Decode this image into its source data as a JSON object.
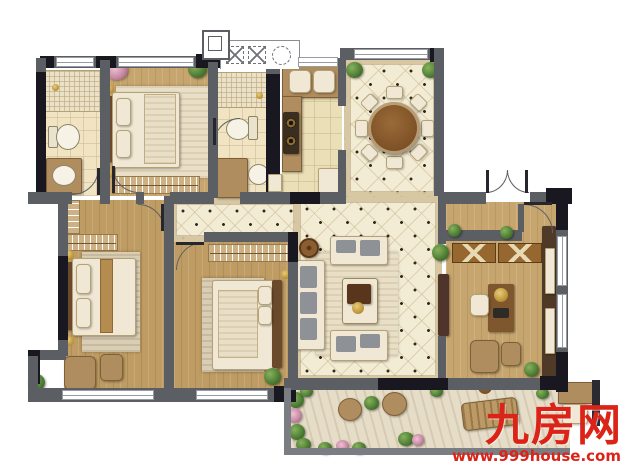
{
  "watermark": {
    "site_name": "九房网",
    "site_url": "www.999house.com",
    "color": "#dc2318"
  },
  "palette": {
    "wall": "#5b5e63",
    "wall_dark": "#191820",
    "wood_floor": "#c7a56e",
    "tile_floor": "#f3ecd4",
    "bath_floor": "#f0e4c2",
    "kitchen_floor": "#eadfb6",
    "stone_floor": "#e6ddc8",
    "furniture_cream": "#f0e8d4",
    "furniture_brown": "#a3754a",
    "plant_green": "#4c7a33",
    "dining_table_brown": "#8a5a2e",
    "cushion_gray": "#8e9296"
  },
  "floorplan": {
    "type": "apartment-floor-plan",
    "rooms": [
      {
        "id": "bathroom-1",
        "furniture": [
          "shower-area",
          "toilet",
          "vanity-sink"
        ]
      },
      {
        "id": "bedroom-2",
        "furniture": [
          "double-bed",
          "rug",
          "hanger-wardrobe",
          "flower-pot",
          "plant"
        ]
      },
      {
        "id": "bathroom-2",
        "furniture": [
          "shower-area",
          "toilet",
          "vanity",
          "round-sink"
        ]
      },
      {
        "id": "kitchen",
        "furniture": [
          "double-sink-counter",
          "cooktop",
          "refrigerator",
          "water-heater"
        ]
      },
      {
        "id": "equipment-platform",
        "furniture": [
          "dashed-ac-unit",
          "dashed-ac-unit",
          "dashed-fan-circle",
          "flue-shaft"
        ]
      },
      {
        "id": "dining-room",
        "furniture": [
          "round-dining-table",
          "eight-chairs",
          "corner-plants"
        ]
      },
      {
        "id": "entry-hall",
        "furniture": [
          "double-entry-door"
        ]
      },
      {
        "id": "living-room",
        "furniture": [
          "three-seat-sofa",
          "loveseat",
          "loveseat",
          "coffee-table",
          "rug",
          "round-side-table",
          "tv-cabinet",
          "plant"
        ]
      },
      {
        "id": "master-bedroom",
        "furniture": [
          "double-bed",
          "rug",
          "closet-shelf",
          "hanger-wardrobe",
          "armchair",
          "ottoman",
          "plant"
        ]
      },
      {
        "id": "bedroom-3",
        "furniture": [
          "double-bed",
          "rug",
          "hanger-wardrobe",
          "plant"
        ]
      },
      {
        "id": "study",
        "furniture": [
          "desk",
          "desk-chair",
          "x-front-console",
          "bookshelf",
          "armchair",
          "ottoman",
          "plants"
        ]
      },
      {
        "id": "terrace",
        "furniture": [
          "round-chair",
          "round-chair",
          "plant-stand",
          "lounge-chaise",
          "side-table",
          "planting-beds",
          "storage-cabinet"
        ]
      }
    ]
  }
}
